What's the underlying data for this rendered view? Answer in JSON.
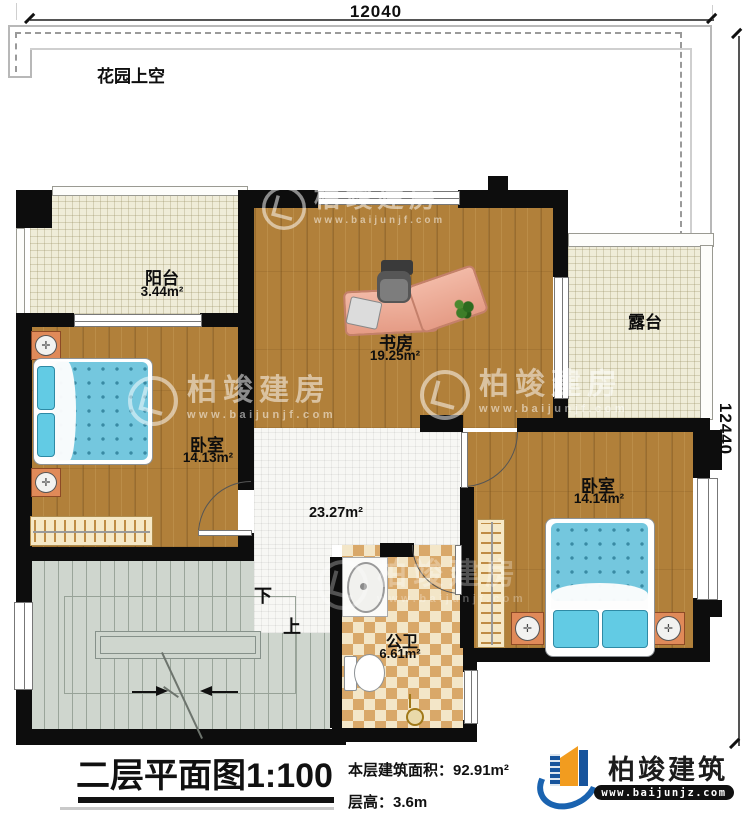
{
  "dimensions": {
    "top": "12040",
    "right": "12440"
  },
  "garden": {
    "label": "花园上空"
  },
  "rooms": {
    "balcony": {
      "name": "阳台",
      "area": "3.44m²"
    },
    "study": {
      "name": "书房",
      "area": "19.25m²"
    },
    "terrace": {
      "name": "露台"
    },
    "bedroom_left": {
      "name": "卧室",
      "area": "14.13m²"
    },
    "bedroom_right": {
      "name": "卧室",
      "area": "14.14m²"
    },
    "hall": {
      "area": "23.27m²"
    },
    "bathroom": {
      "name": "公卫",
      "area": "6.61m²"
    }
  },
  "stairs": {
    "down_label": "下",
    "up_label": "上"
  },
  "title_block": {
    "title": "二层平面图",
    "scale": "1:100",
    "area_line": "本层建筑面积：92.91m²",
    "floor_height_line": "层高：3.6m"
  },
  "branding": {
    "logo_text": "柏竣建筑",
    "logo_url": "www.baijunjz.com",
    "watermark_text": "柏竣建房",
    "watermark_url": "www.baijunjf.com"
  },
  "colors": {
    "wall": "#0d0d0d",
    "wood_floor": "#b1803a",
    "balcony_tile": "#efecd8",
    "hall_tile": "#f7f7f4",
    "bath_checker_dark": "#d9a869",
    "bath_checker_light": "#f3e6c8",
    "stairs_gray": "#cfd6ce",
    "bed_blue": "#74c7de",
    "brand_blue": "#1a63b0",
    "brand_orange": "#f29c1f"
  }
}
